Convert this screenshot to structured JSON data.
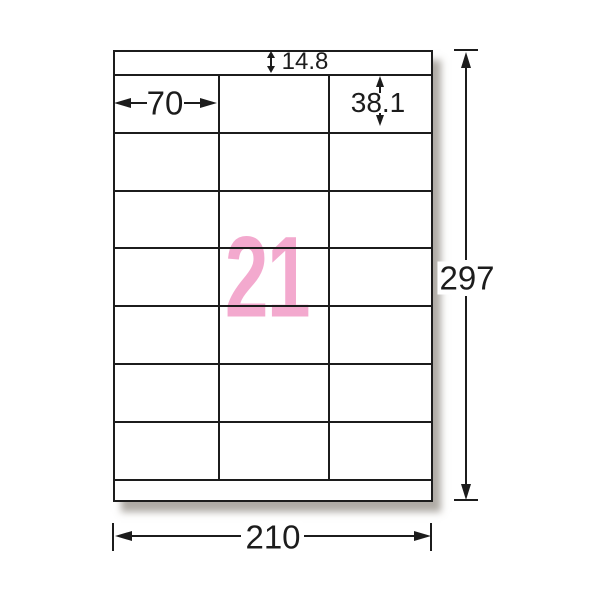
{
  "diagram": {
    "sheet": {
      "label_count": "21",
      "columns": 3,
      "rows": 7
    },
    "dimensions": {
      "top_margin": "14.8",
      "label_width": "70",
      "label_height": "38.1",
      "sheet_width": "210",
      "sheet_height": "297"
    },
    "colors": {
      "count_pink": "#f3a9ce",
      "line": "#1c1c1c",
      "paper": "#ffffff",
      "background": "#ffffff",
      "shadow": "rgba(95,88,76,0.50)"
    }
  }
}
